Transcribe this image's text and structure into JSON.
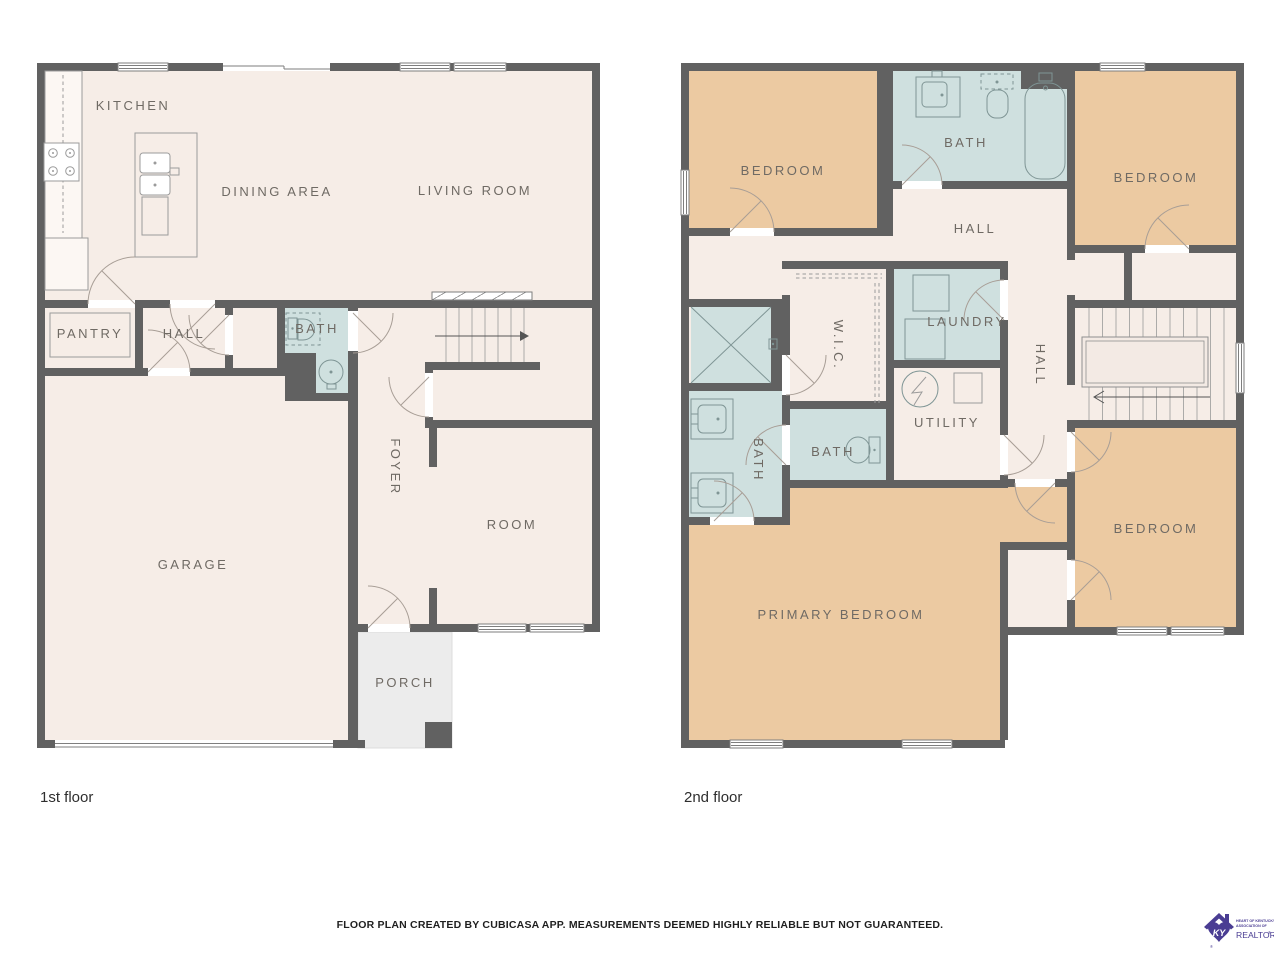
{
  "captions": {
    "floor1": "1st floor",
    "floor2": "2nd floor"
  },
  "footer": {
    "disclaimer": "FLOOR PLAN CREATED BY CUBICASA APP. MEASUREMENTS DEEMED HIGHLY RELIABLE BUT NOT GUARANTEED."
  },
  "colors": {
    "wall": "#616161",
    "floor": "#f6ede7",
    "bedroom": "#eccaa2",
    "wet_room": "#cfe0df",
    "porch": "#ececec",
    "label_text": "#6f6a64",
    "logo_purple": "#4a3d93"
  },
  "floor1": {
    "rooms": {
      "kitchen": "KITCHEN",
      "dining": "DINING AREA",
      "living": "LIVING ROOM",
      "pantry": "PANTRY",
      "hall": "HALL",
      "bath": "BATH",
      "foyer": "FOYER",
      "room": "ROOM",
      "garage": "GARAGE",
      "porch": "PORCH"
    }
  },
  "floor2": {
    "rooms": {
      "bedroom_tl": "BEDROOM",
      "bath_top": "BATH",
      "bedroom_tr": "BEDROOM",
      "hall_top": "HALL",
      "wic": "W.I.C.",
      "laundry": "LAUNDRY",
      "bath_left": "BATH",
      "bath_small": "BATH",
      "utility": "UTILITY",
      "hall_vert": "HALL",
      "bedroom_br": "BEDROOM",
      "primary": "PRIMARY BEDROOM"
    }
  },
  "logo": {
    "org_line1": "HEART OF KENTUCKY",
    "org_line2": "ASSOCIATION OF",
    "brand": "REALTORS",
    "reg": "®",
    "monogram": "KY"
  }
}
